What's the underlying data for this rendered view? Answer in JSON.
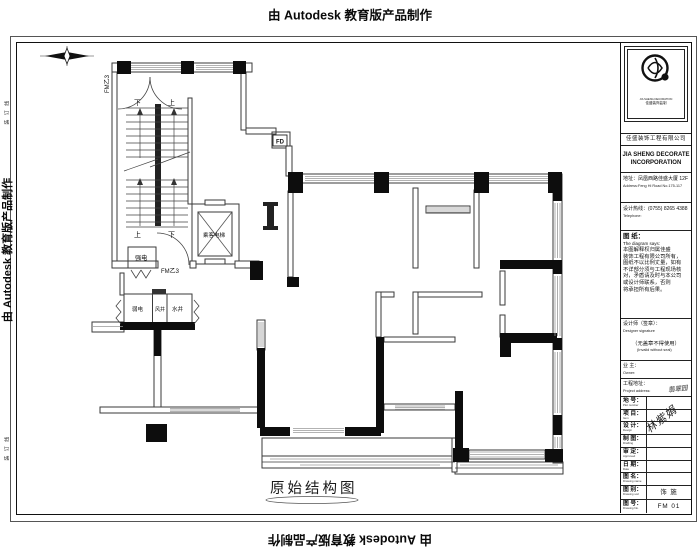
{
  "watermarks": {
    "top": "由 Autodesk 教育版产品制作",
    "bottom": "由 Autodesk 教育版产品制作",
    "left": "由 Autodesk 教育版产品制作",
    "right": "由 Autodesk 教育版产品制作"
  },
  "margin": {
    "binding_line_top": "装 订 线",
    "binding_line_bottom": "装 订 线"
  },
  "plan": {
    "title": "原始结构图",
    "fm_door_top": "FM乙3",
    "fm_door_bottom": "FM乙3",
    "stair_top_down": "下",
    "stair_top_up": "上",
    "stair_bottom_up": "上",
    "stair_bottom_down": "下",
    "strong_electric_room": "强电",
    "passenger_elevator": "乘客电梯",
    "weak_electric_shaft": "弱电",
    "air_shaft": "风井",
    "water_shaft": "水井",
    "floor_drain": "FD"
  },
  "titleblock": {
    "logo_caption_en": "JIA SHENG DECORATION",
    "logo_caption_cn": "佳盛装饰监制",
    "company_cn": "佳盛装饰工程有限公司",
    "company_en_line1": "JIA SHENG DECORATE",
    "company_en_line2": "INCORPORATION",
    "address_cn": "地址：凤凰西路佳盛大厦 12F",
    "address_en": "Address:Feng Hi Road No.175-117",
    "phone_cn": "设计热线：(0755) 8265 4388",
    "phone_en": "Telephone:",
    "note_title": "图 纸：",
    "note_subtitle": "The diagram says:",
    "note_lines": [
      "本图解释权归属佳盛",
      "装饰工程有限公司所有，",
      "图纸不以比例丈量，如有",
      "不详部分须与工程现场核",
      "对，矛盾请及时与本公司",
      "或设计师联系，否则",
      "将承担所有后果。"
    ],
    "designer_label": "设计师（签章）：",
    "designer_en": "Designer signature",
    "seal_note": "（无盖章不得使用）",
    "seal_note_en": "(Invalid without seal)",
    "owner_label": "业 主：",
    "owner_en": "Owner:",
    "site_label": "工程地址：",
    "site_en": "Project address:",
    "site_value": "翡翠园",
    "signature": "林紫娟",
    "rows": [
      {
        "label": "地 号：",
        "en": "Plot number",
        "value": ""
      },
      {
        "label": "项 目：",
        "en": "Item",
        "value": ""
      },
      {
        "label": "设 计：",
        "en": "Design",
        "value": ""
      },
      {
        "label": "制 图：",
        "en": "Drafting",
        "value": ""
      },
      {
        "label": "审 定：",
        "en": "Approved",
        "value": ""
      },
      {
        "label": "日 期：",
        "en": "Date",
        "value": ""
      },
      {
        "label": "图 名：",
        "en": "Drawing name",
        "value": ""
      },
      {
        "label": "图 别：",
        "en": "Drawing sort",
        "value": "饰 施"
      },
      {
        "label": "图 号：",
        "en": "Drawing No.",
        "value": "FM 01"
      }
    ]
  }
}
